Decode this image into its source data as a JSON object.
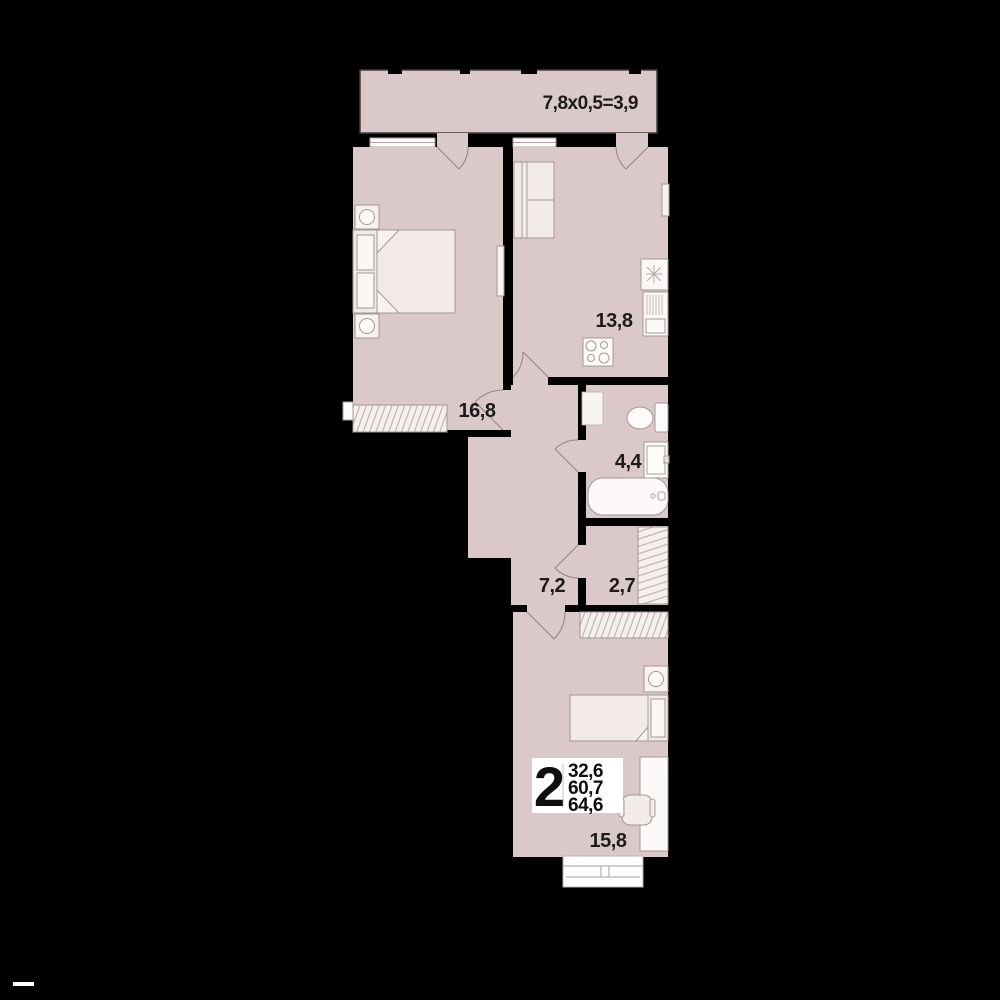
{
  "plan_title": "2-room apartment floor plan",
  "colors": {
    "background": "#000000",
    "floor_fill": "#dbc9c9",
    "furniture_light": "#f1eae8",
    "fixture_white": "#fcf9f8",
    "outline": "#a39896",
    "label": "#1b1b1b"
  },
  "balcony": {
    "dimension_label": "7,8x0,5=3,9"
  },
  "rooms": {
    "bedroom": {
      "area": "16,8"
    },
    "kitchen": {
      "area": "13,8"
    },
    "bathroom": {
      "area": "4,4"
    },
    "hallway": {
      "area": "7,2"
    },
    "storage": {
      "area": "2,7"
    },
    "living_room": {
      "area": "15,8"
    }
  },
  "info_badge": {
    "rooms_count": "2",
    "values": [
      "32,6",
      "60,7",
      "64,6"
    ]
  }
}
